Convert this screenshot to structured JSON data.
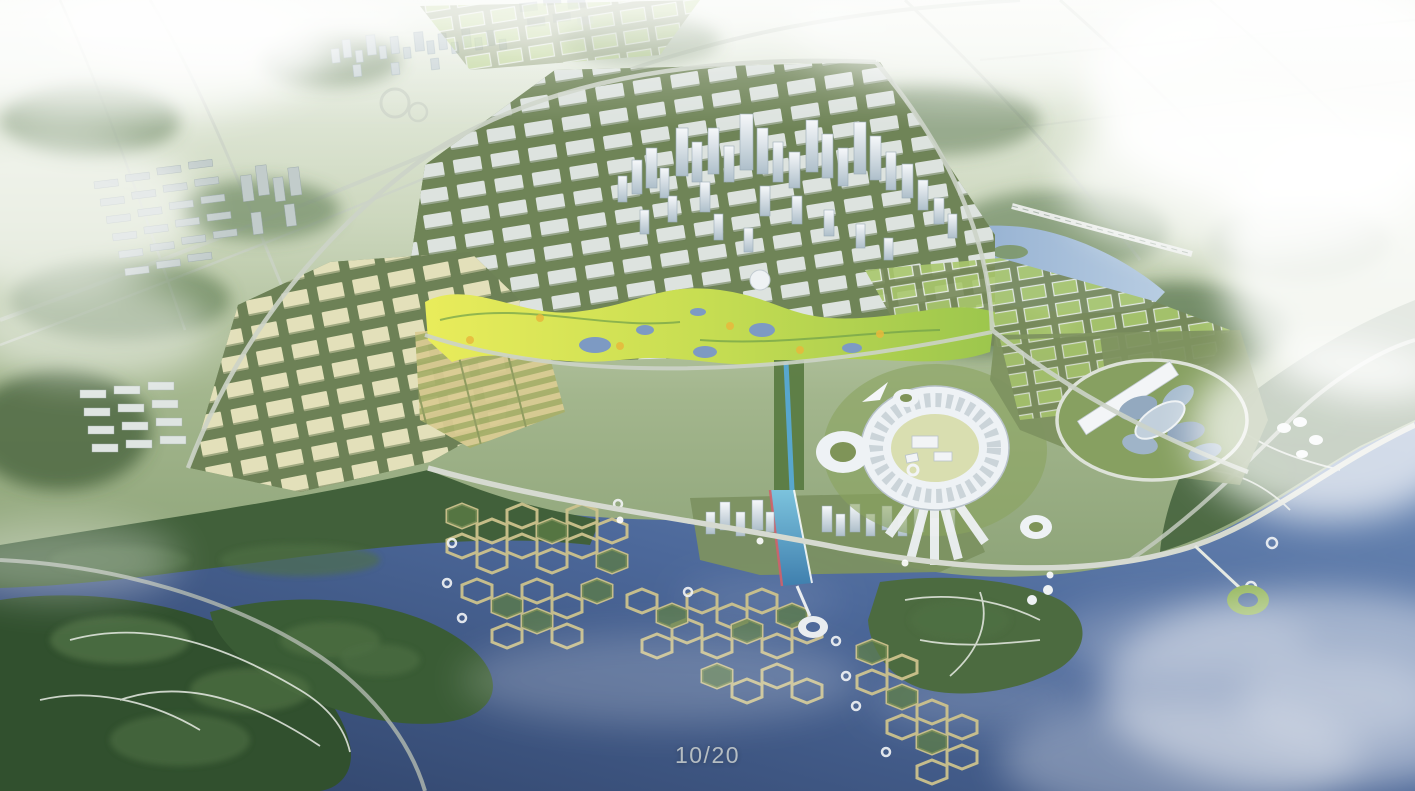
{
  "viewer": {
    "counter": "10/20"
  },
  "palette": {
    "haze_white": "#ffffff",
    "land_light": "#ccd7bd",
    "land_green": "#8aa073",
    "forest_dark": "#3d5a37",
    "forest_mid": "#57744a",
    "park_yellow": "#e8ea58",
    "park_green": "#9cc64d",
    "water_deep": "#2e4166",
    "water_mid": "#4c689a",
    "water_light": "#7d9ac3",
    "building_white": "#e3e8e6",
    "tower_light": "#f4f7f9",
    "tower_shade": "#aabbc6",
    "campus_roof": "#e9e5bf",
    "green_roof": "#a9c76c",
    "road": "#ccd3c8",
    "cell_path": "#cdc28d",
    "canal_blue": "#58a7cd",
    "accent_red": "#d2606a"
  }
}
